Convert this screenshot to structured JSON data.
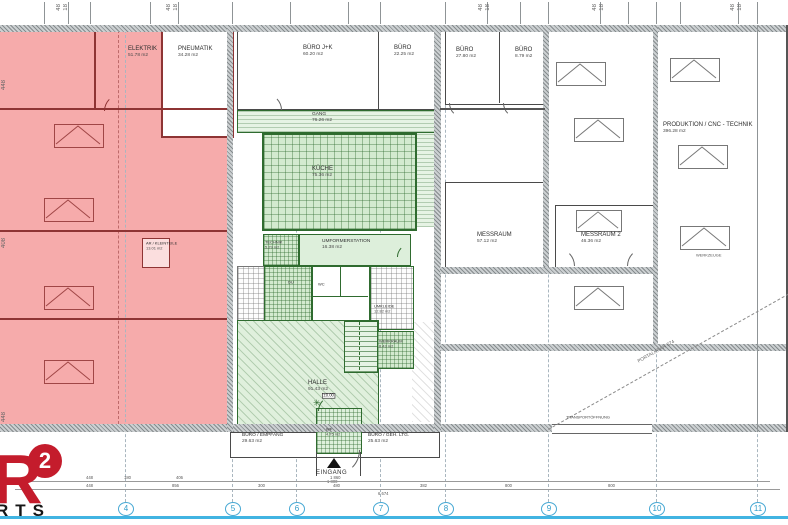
{
  "plan": {
    "rooms": {
      "elektrik": {
        "name": "ELEKTRIK",
        "area": "51.78 m2"
      },
      "pneumatik": {
        "name": "PNEUMATIK",
        "area": "34.28 m2"
      },
      "ar_kleinteile": {
        "name": "AR / KLEINTEILE",
        "area": "13.01 m2"
      },
      "buero_jk": {
        "name": "BÜRO J+K",
        "area": "60.20 m2"
      },
      "buero_k": {
        "name": "BÜRO",
        "area": "22.25 m2"
      },
      "buero_l": {
        "name": "BÜRO",
        "area": "27.80 m2"
      },
      "buero_s": {
        "name": "BÜRO",
        "area": "8.79 m2"
      },
      "gang": {
        "name": "GANG",
        "area": "76.26 m2"
      },
      "kueche": {
        "name": "KÜCHE",
        "area": "75.36 m2"
      },
      "technik": {
        "name": "TECHNIK",
        "area": "5.29 m2"
      },
      "umformerstation": {
        "name": "UMFORMERSTATION",
        "area": "16.38 m2"
      },
      "wc": {
        "name": "WC"
      },
      "du": {
        "name": "DU"
      },
      "umkleide": {
        "name": "UMKLEIDE",
        "area": "12.82 m2"
      },
      "werkraum": {
        "name": "WERKRAUM",
        "area": "8.43 m2"
      },
      "halle": {
        "name": "HALLE",
        "area": "91.43 m2"
      },
      "wf": {
        "name": "WF",
        "area": "4.75 m2"
      },
      "buero_empfang": {
        "name": "BÜRO / EMPFANG",
        "area": "29.63 m2"
      },
      "buero_geh_ltg": {
        "name": "BÜRO / GEH. LTG.",
        "area": "25.63 m2"
      },
      "messraum": {
        "name": "MESSRAUM",
        "area": "57.12 m2"
      },
      "messraum2": {
        "name": "MESSRAUM 2",
        "area": "46.36 m2"
      },
      "produktion": {
        "name": "PRODUKTION / CNC - TECHNIK",
        "area": "396.28 m2"
      },
      "werkzeuge": {
        "name": "WERKZEUGE"
      },
      "eingang": {
        "name": "EINGANG"
      }
    },
    "annotations": {
      "portalkran": "PORTALKRAN 574",
      "transportoeffnung": "TRANSPORTÖFFNUNG",
      "level": "±0.00",
      "eingang_dim": "1 800",
      "total_dim": "6 674"
    },
    "grid": {
      "bubbles": [
        "4",
        "5",
        "6",
        "7",
        "8",
        "9",
        "10",
        "11"
      ]
    },
    "dims": {
      "bottom_row1": [
        "448",
        "180",
        "406",
        "1 860"
      ],
      "bottom_row2": [
        "448",
        "856",
        "300",
        "480",
        "382",
        "800",
        "800"
      ],
      "left": [
        "448",
        "408",
        "448"
      ],
      "top": [
        "48",
        "18"
      ]
    },
    "logo": {
      "letter": "R",
      "sup": "2",
      "word": "RTS"
    },
    "colors": {
      "zone_red": "#f6abab",
      "zone_green": "#d3eacf",
      "accent": "#41b4e2"
    }
  }
}
